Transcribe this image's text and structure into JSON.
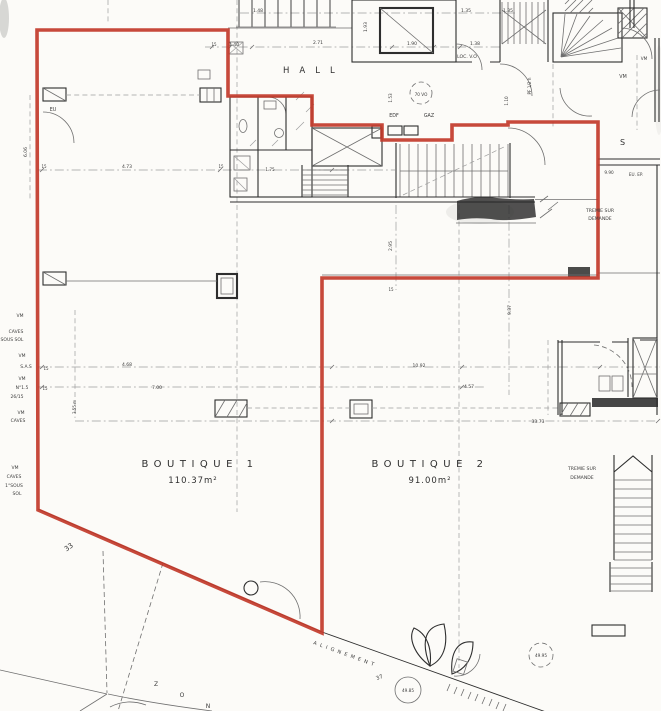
{
  "colors": {
    "outline": "#c2392a",
    "ink": "#2e2e2e",
    "paper": "#fcfbf8"
  },
  "texts": {
    "hall": "HALL",
    "sa": "S A",
    "loc_vo": "LOC. V.O",
    "alignement": "ALIGNEMENT",
    "boutique1": {
      "name": "BOUTIQUE 1",
      "area": "110.37m²"
    },
    "boutique2": {
      "name": "BOUTIQUE 2",
      "area": "91.00m²"
    },
    "tremie_center": {
      "line1": "TREMIE SUR",
      "line2": "DEMANDE"
    },
    "tremie_right": {
      "line1": "TREMIE SUR",
      "line2": "DEMANDE"
    }
  },
  "dimension_labels": [
    {
      "t": "1.48",
      "x": 258,
      "y": 12
    },
    {
      "t": "1.35",
      "x": 466,
      "y": 12
    },
    {
      "t": "1.35",
      "x": 508,
      "y": 12
    },
    {
      "t": "15",
      "x": 214,
      "y": 46,
      "s": 4
    },
    {
      "t": "1.40",
      "x": 234,
      "y": 46
    },
    {
      "t": "2.71",
      "x": 318,
      "y": 44
    },
    {
      "t": "1.93",
      "x": 367,
      "y": 27,
      "r": -90
    },
    {
      "t": "1.90",
      "x": 412,
      "y": 45
    },
    {
      "t": "1.38",
      "x": 475,
      "y": 45
    },
    {
      "t": "70 VO",
      "x": 421,
      "y": 96,
      "s": 4.2
    },
    {
      "t": "EDF",
      "x": 394,
      "y": 117,
      "s": 4.8
    },
    {
      "t": "GAZ",
      "x": 429,
      "y": 117,
      "s": 4.8
    },
    {
      "t": "1.53",
      "x": 392,
      "y": 98,
      "r": -90,
      "s": 4.2
    },
    {
      "t": "PF 1/2 h",
      "x": 531,
      "y": 86,
      "r": -90,
      "s": 4.2
    },
    {
      "t": "1.10",
      "x": 508,
      "y": 101,
      "r": -90,
      "s": 4.2
    },
    {
      "t": "VM",
      "x": 623,
      "y": 78,
      "s": 4.8
    },
    {
      "t": "VM",
      "x": 644,
      "y": 60,
      "s": 4.2
    },
    {
      "t": "EU",
      "x": 53,
      "y": 111,
      "s": 4.8
    },
    {
      "t": "6.06",
      "x": 27,
      "y": 152,
      "r": -90
    },
    {
      "t": "4.73",
      "x": 127,
      "y": 168
    },
    {
      "t": "15",
      "x": 44,
      "y": 168,
      "s": 4
    },
    {
      "t": "15",
      "x": 221,
      "y": 168,
      "s": 4
    },
    {
      "t": "1.75",
      "x": 270,
      "y": 171,
      "s": 4.2
    },
    {
      "t": "9.90",
      "x": 609,
      "y": 174,
      "s": 4.2
    },
    {
      "t": "EU. EP.",
      "x": 636,
      "y": 176,
      "s": 4.2
    },
    {
      "t": "2.95",
      "x": 392,
      "y": 246,
      "r": -90
    },
    {
      "t": "15",
      "x": 391,
      "y": 291,
      "s": 4
    },
    {
      "t": "9.37",
      "x": 511,
      "y": 310,
      "r": -90
    },
    {
      "t": "VM",
      "x": 20,
      "y": 317,
      "s": 4.5
    },
    {
      "t": "CAVES",
      "x": 16,
      "y": 333,
      "s": 4.5
    },
    {
      "t": "SOUS SOL",
      "x": 12,
      "y": 341,
      "s": 4.5
    },
    {
      "t": "VM",
      "x": 22,
      "y": 357,
      "s": 4.5
    },
    {
      "t": "S.A.S",
      "x": 26,
      "y": 368,
      "s": 4.5
    },
    {
      "t": "15",
      "x": 46,
      "y": 370,
      "s": 4
    },
    {
      "t": "VM",
      "x": 22,
      "y": 380,
      "s": 4.5
    },
    {
      "t": "N°1.5",
      "x": 22,
      "y": 389,
      "s": 4.5
    },
    {
      "t": "15",
      "x": 45,
      "y": 390,
      "s": 4
    },
    {
      "t": "26/15",
      "x": 17,
      "y": 398,
      "s": 4.5
    },
    {
      "t": "3.55 m",
      "x": 76,
      "y": 407,
      "r": -90,
      "s": 4
    },
    {
      "t": "4.68",
      "x": 127,
      "y": 366
    },
    {
      "t": "7.00",
      "x": 157,
      "y": 389
    },
    {
      "t": "10.92",
      "x": 419,
      "y": 367
    },
    {
      "t": "4.57",
      "x": 469,
      "y": 388
    },
    {
      "t": "33.73",
      "x": 538,
      "y": 423
    },
    {
      "t": "VM",
      "x": 21,
      "y": 414,
      "s": 4.5
    },
    {
      "t": "CAVES",
      "x": 18,
      "y": 422,
      "s": 4.5
    },
    {
      "t": "VM",
      "x": 15,
      "y": 469,
      "s": 4.5
    },
    {
      "t": "CAVES",
      "x": 14,
      "y": 478,
      "s": 4.5
    },
    {
      "t": "1°SOUS",
      "x": 14,
      "y": 487,
      "s": 4.5
    },
    {
      "t": "SOL",
      "x": 17,
      "y": 495,
      "s": 4.5
    },
    {
      "t": "33",
      "x": 70,
      "y": 549,
      "s": 7,
      "r": -35
    },
    {
      "t": "37",
      "x": 380,
      "y": 679,
      "s": 5.5,
      "r": -22
    },
    {
      "t": "49.85",
      "x": 408,
      "y": 692,
      "s": 4.2
    },
    {
      "t": "49.95",
      "x": 541,
      "y": 657,
      "s": 4.2
    },
    {
      "t": "Z",
      "x": 156,
      "y": 686,
      "s": 6
    },
    {
      "t": "O",
      "x": 182,
      "y": 697,
      "s": 6
    },
    {
      "t": "N",
      "x": 208,
      "y": 708,
      "s": 6
    }
  ]
}
